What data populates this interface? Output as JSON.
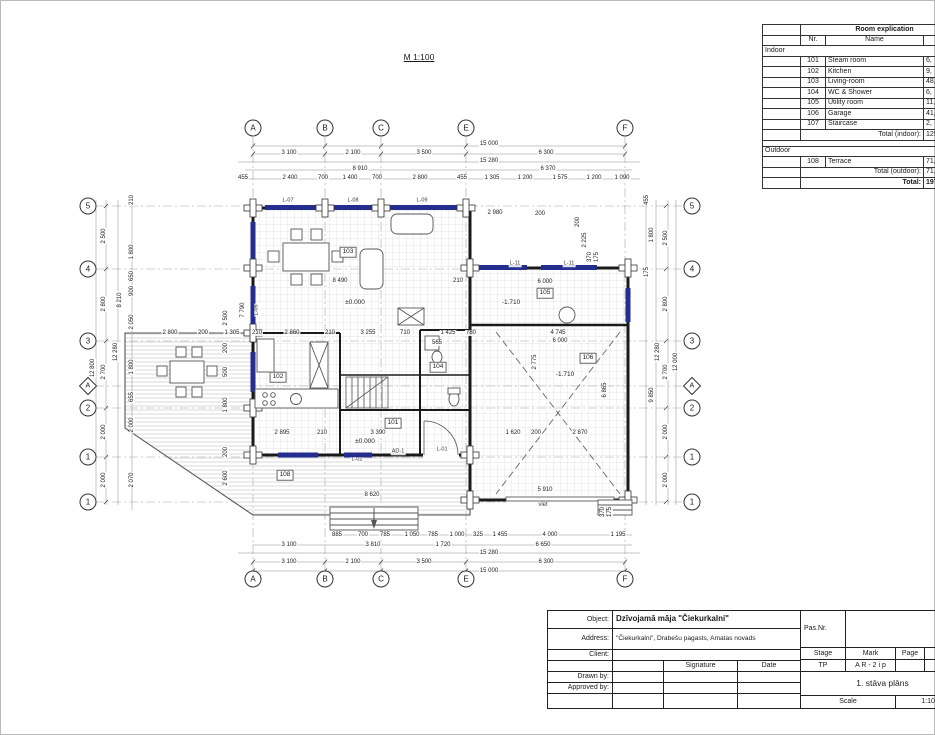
{
  "drawing": {
    "scale_label": "M 1:100",
    "grid": {
      "top": [
        [
          "A",
          253
        ],
        [
          "B",
          325
        ],
        [
          "C",
          381
        ],
        [
          "E",
          466
        ],
        [
          "F",
          625
        ]
      ],
      "bottom": [
        [
          "A",
          253
        ],
        [
          "B",
          325
        ],
        [
          "C",
          381
        ],
        [
          "E",
          466
        ],
        [
          "F",
          625
        ]
      ],
      "left": [
        [
          "5",
          206
        ],
        [
          "4",
          269
        ],
        [
          "3",
          341
        ],
        [
          "A",
          386,
          "d"
        ],
        [
          "2",
          408
        ],
        [
          "1",
          457
        ],
        [
          "1",
          502
        ]
      ],
      "right": [
        [
          "5",
          206
        ],
        [
          "4",
          269
        ],
        [
          "3",
          341
        ],
        [
          "A",
          386,
          "d"
        ],
        [
          "2",
          408
        ],
        [
          "1",
          457
        ],
        [
          "1",
          502
        ]
      ]
    },
    "labels": [
      [
        "15 000",
        489,
        144
      ],
      [
        "3 100",
        289,
        153
      ],
      [
        "2 100",
        353,
        153
      ],
      [
        "3 500",
        424,
        153
      ],
      [
        "6 300",
        546,
        153
      ],
      [
        "15 280",
        489,
        161
      ],
      [
        "8 910",
        360,
        169
      ],
      [
        "6 370",
        548,
        169
      ],
      [
        "455",
        243,
        178
      ],
      [
        "2 400",
        290,
        178
      ],
      [
        "700",
        323,
        178
      ],
      [
        "1 400",
        350,
        178
      ],
      [
        "700",
        377,
        178
      ],
      [
        "2 800",
        420,
        178
      ],
      [
        "455",
        462,
        178
      ],
      [
        "1 305",
        492,
        178
      ],
      [
        "1 200",
        525,
        178
      ],
      [
        "1 575",
        560,
        178
      ],
      [
        "1 200",
        594,
        178
      ],
      [
        "1 090",
        622,
        178
      ],
      [
        "885",
        337,
        535
      ],
      [
        "700",
        363,
        535
      ],
      [
        "785",
        385,
        535
      ],
      [
        "1 050",
        412,
        535
      ],
      [
        "785",
        433,
        535
      ],
      [
        "1 000",
        457,
        535
      ],
      [
        "325",
        478,
        535
      ],
      [
        "1 455",
        500,
        535
      ],
      [
        "4 000",
        550,
        535
      ],
      [
        "1 195",
        618,
        535
      ],
      [
        "3 100",
        289,
        545
      ],
      [
        "3 810",
        373,
        545
      ],
      [
        "1 720",
        443,
        545
      ],
      [
        "6 650",
        543,
        545
      ],
      [
        "15 280",
        489,
        553
      ],
      [
        "3 100",
        289,
        562
      ],
      [
        "2 100",
        353,
        562
      ],
      [
        "3 500",
        424,
        562
      ],
      [
        "6 300",
        546,
        562
      ],
      [
        "15 000",
        489,
        571
      ],
      [
        "12 800",
        93,
        368,
        "dim",
        1
      ],
      [
        "2 500",
        104,
        236,
        "dim",
        1
      ],
      [
        "2 800",
        104,
        304,
        "dim",
        1
      ],
      [
        "2 700",
        104,
        372,
        "dim",
        1
      ],
      [
        "2 000",
        104,
        432,
        "dim",
        1
      ],
      [
        "2 000",
        104,
        480,
        "dim",
        1
      ],
      [
        "12 280",
        116,
        352,
        "dim",
        1
      ],
      [
        "8 210",
        120,
        300,
        "dim",
        1
      ],
      [
        "210",
        132,
        200,
        "dim",
        1
      ],
      [
        "1 800",
        132,
        252,
        "dim",
        1
      ],
      [
        "650",
        132,
        276,
        "dim",
        1
      ],
      [
        "900",
        132,
        291,
        "dim",
        1
      ],
      [
        "2 050",
        132,
        322,
        "dim",
        1
      ],
      [
        "1 800",
        132,
        367,
        "dim",
        1
      ],
      [
        "655",
        132,
        397,
        "dim",
        1
      ],
      [
        "2 000",
        132,
        425,
        "dim",
        1
      ],
      [
        "2 070",
        132,
        480,
        "dim",
        1
      ],
      [
        "455",
        647,
        200,
        "dim",
        1
      ],
      [
        "1 800",
        652,
        235,
        "dim",
        1
      ],
      [
        "2 500",
        666,
        238,
        "dim",
        1
      ],
      [
        "175",
        647,
        272,
        "dim",
        1
      ],
      [
        "2 800",
        666,
        304,
        "dim",
        1
      ],
      [
        "12 280",
        658,
        352,
        "dim",
        1
      ],
      [
        "2 700",
        666,
        372,
        "dim",
        1
      ],
      [
        "12 000",
        676,
        362,
        "dim",
        1
      ],
      [
        "9 850",
        652,
        395,
        "dim",
        1
      ],
      [
        "2 000",
        666,
        432,
        "dim",
        1
      ],
      [
        "2 000",
        666,
        480,
        "dim",
        1
      ],
      [
        "370",
        603,
        512,
        "dim",
        1
      ],
      [
        "175",
        610,
        512,
        "dim",
        1
      ],
      [
        "2 980",
        495,
        213
      ],
      [
        "200",
        540,
        214
      ],
      [
        "200",
        578,
        222,
        "dim",
        1
      ],
      [
        "2 225",
        585,
        240,
        "dim",
        1
      ],
      [
        "370",
        590,
        257,
        "dim",
        1
      ],
      [
        "175",
        597,
        257,
        "dim",
        1
      ],
      [
        "8 490",
        340,
        281
      ],
      [
        "210",
        458,
        281
      ],
      [
        "6 000",
        545,
        282
      ],
      [
        "4 745",
        558,
        333
      ],
      [
        "6 000",
        560,
        341
      ],
      [
        "2 800",
        170,
        333
      ],
      [
        "200",
        203,
        333
      ],
      [
        "1 305",
        232,
        333
      ],
      [
        "210",
        257,
        333
      ],
      [
        "2 860",
        292,
        333
      ],
      [
        "210",
        330,
        333
      ],
      [
        "3 255",
        368,
        333
      ],
      [
        "710",
        405,
        333
      ],
      [
        "1 425",
        448,
        333
      ],
      [
        "780",
        471,
        333
      ],
      [
        "565",
        437,
        343
      ],
      [
        "7 790",
        243,
        310,
        "dim",
        1
      ],
      [
        "2 775",
        535,
        362,
        "dim",
        1
      ],
      [
        "6 865",
        605,
        390,
        "dim",
        1
      ],
      [
        "2 500",
        226,
        318,
        "dim",
        1
      ],
      [
        "200",
        226,
        348,
        "dim",
        1
      ],
      [
        "500",
        226,
        372,
        "dim",
        1
      ],
      [
        "1 800",
        226,
        405,
        "dim",
        1
      ],
      [
        "200",
        226,
        452,
        "dim",
        1
      ],
      [
        "2 600",
        226,
        478,
        "dim",
        1
      ],
      [
        "2 895",
        282,
        433
      ],
      [
        "210",
        322,
        433
      ],
      [
        "3 390",
        378,
        433
      ],
      [
        "1 620",
        513,
        433
      ],
      [
        "200",
        536,
        433
      ],
      [
        "2 870",
        580,
        433
      ],
      [
        "5 910",
        545,
        490
      ],
      [
        "8 620",
        372,
        495
      ],
      [
        "±0.000",
        355,
        303,
        "lvl"
      ],
      [
        "-1.710",
        511,
        303,
        "lvl"
      ],
      [
        "-1.710",
        565,
        375,
        "lvl"
      ],
      [
        "±0.000",
        365,
        442,
        "lvl"
      ],
      [
        "L-07",
        288,
        201,
        "win"
      ],
      [
        "L-08",
        353,
        201,
        "win"
      ],
      [
        "L-09",
        422,
        201,
        "win"
      ],
      [
        "L-11",
        515,
        264,
        "win"
      ],
      [
        "L-11",
        569,
        264,
        "win"
      ],
      [
        "L-06",
        257,
        310,
        "win",
        1
      ],
      [
        "L-02",
        357,
        460,
        "win"
      ],
      [
        "L-01",
        442,
        450,
        "win"
      ],
      [
        "AD-1",
        398,
        452,
        "win"
      ],
      [
        "viet",
        543,
        505,
        "note"
      ],
      [
        "103",
        348,
        252,
        "tag"
      ],
      [
        "102",
        278,
        377,
        "tag"
      ],
      [
        "104",
        438,
        367,
        "tag"
      ],
      [
        "105",
        545,
        293,
        "tag"
      ],
      [
        "106",
        588,
        358,
        "tag"
      ],
      [
        "101",
        393,
        423,
        "tag"
      ],
      [
        "108",
        285,
        475,
        "tag"
      ]
    ]
  },
  "explication": {
    "title": "Room explication",
    "columns": {
      "nr": "Nr.",
      "name": "Name",
      "area": "Area"
    },
    "sections": [
      {
        "name": "Indoor",
        "rows": [
          {
            "nr": "101",
            "name": "Steam room",
            "area": "6,"
          },
          {
            "nr": "102",
            "name": "Kitchen",
            "area": "9,"
          },
          {
            "nr": "103",
            "name": "Living-room",
            "area": "48,"
          },
          {
            "nr": "104",
            "name": "WC & Shower",
            "area": "6,"
          },
          {
            "nr": "105",
            "name": "Utility room",
            "area": "11,"
          },
          {
            "nr": "106",
            "name": "Garage",
            "area": "41,"
          },
          {
            "nr": "107",
            "name": "Staircase",
            "area": "2,"
          }
        ],
        "total_label": "Total (indoor):",
        "total": "125,"
      },
      {
        "name": "Outdoor",
        "rows": [
          {
            "nr": "108",
            "name": "Terrace",
            "area": "71,"
          }
        ],
        "total_label": "Total (outdoor):",
        "total": "71,8"
      }
    ],
    "grand_total_label": "Total:",
    "grand_total": "197,"
  },
  "titleblock": {
    "object_label": "Object:",
    "object": "Dzīvojamā māja \"Čiekurkalni\"",
    "address_label": "Address:",
    "address": "\"Čiekurkalni\", Drabešu pagasts, Amatas novads",
    "client_label": "Client:",
    "pas_label": "Pas.Nr.",
    "signature_label": "Signature",
    "date_label": "Date",
    "drawn_label": "Drawn by:",
    "approved_label": "Approved by:",
    "stage_label": "Stage",
    "mark_label": "Mark",
    "page_label": "Page",
    "pages_label": "P",
    "stage": "TP",
    "mark": "A R - 2 i p",
    "sheet_title": "1. stāva plāns",
    "scale_label": "Scale",
    "scale": "1:100"
  }
}
